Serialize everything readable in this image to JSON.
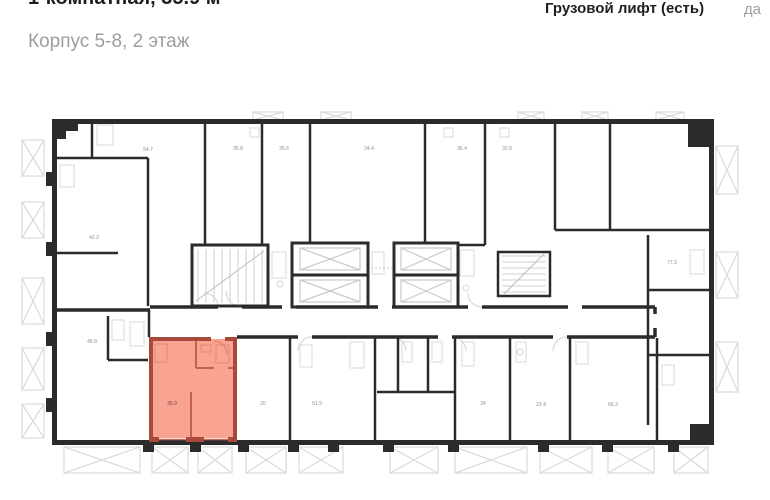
{
  "header": {
    "title": "1-комнатная, 35.9 м²",
    "subtitle": "Корпус 5-8, 2 этаж"
  },
  "spec_row": {
    "label": "Грузовой лифт (есть)",
    "value": "да"
  },
  "plan": {
    "selected_apartment": {
      "label": "35.9"
    },
    "area_labels": [
      {
        "value": "54.7"
      },
      {
        "value": "35.8"
      },
      {
        "value": "35.6"
      },
      {
        "value": "24.4"
      },
      {
        "value": "36.4"
      },
      {
        "value": "32.8"
      },
      {
        "value": "42.2"
      },
      {
        "value": "77.3"
      },
      {
        "value": "46.8"
      },
      {
        "value": "20"
      },
      {
        "value": "51.9"
      },
      {
        "value": "34"
      },
      {
        "value": "22.4"
      },
      {
        "value": "66.3"
      }
    ],
    "colors": {
      "wall": "#2b2b2b",
      "fixture_line": "#d8d8d8",
      "highlight_fill": "#f9a493",
      "highlight_wall": "#a8493b",
      "area_label_text": "#8f8f8f"
    }
  }
}
